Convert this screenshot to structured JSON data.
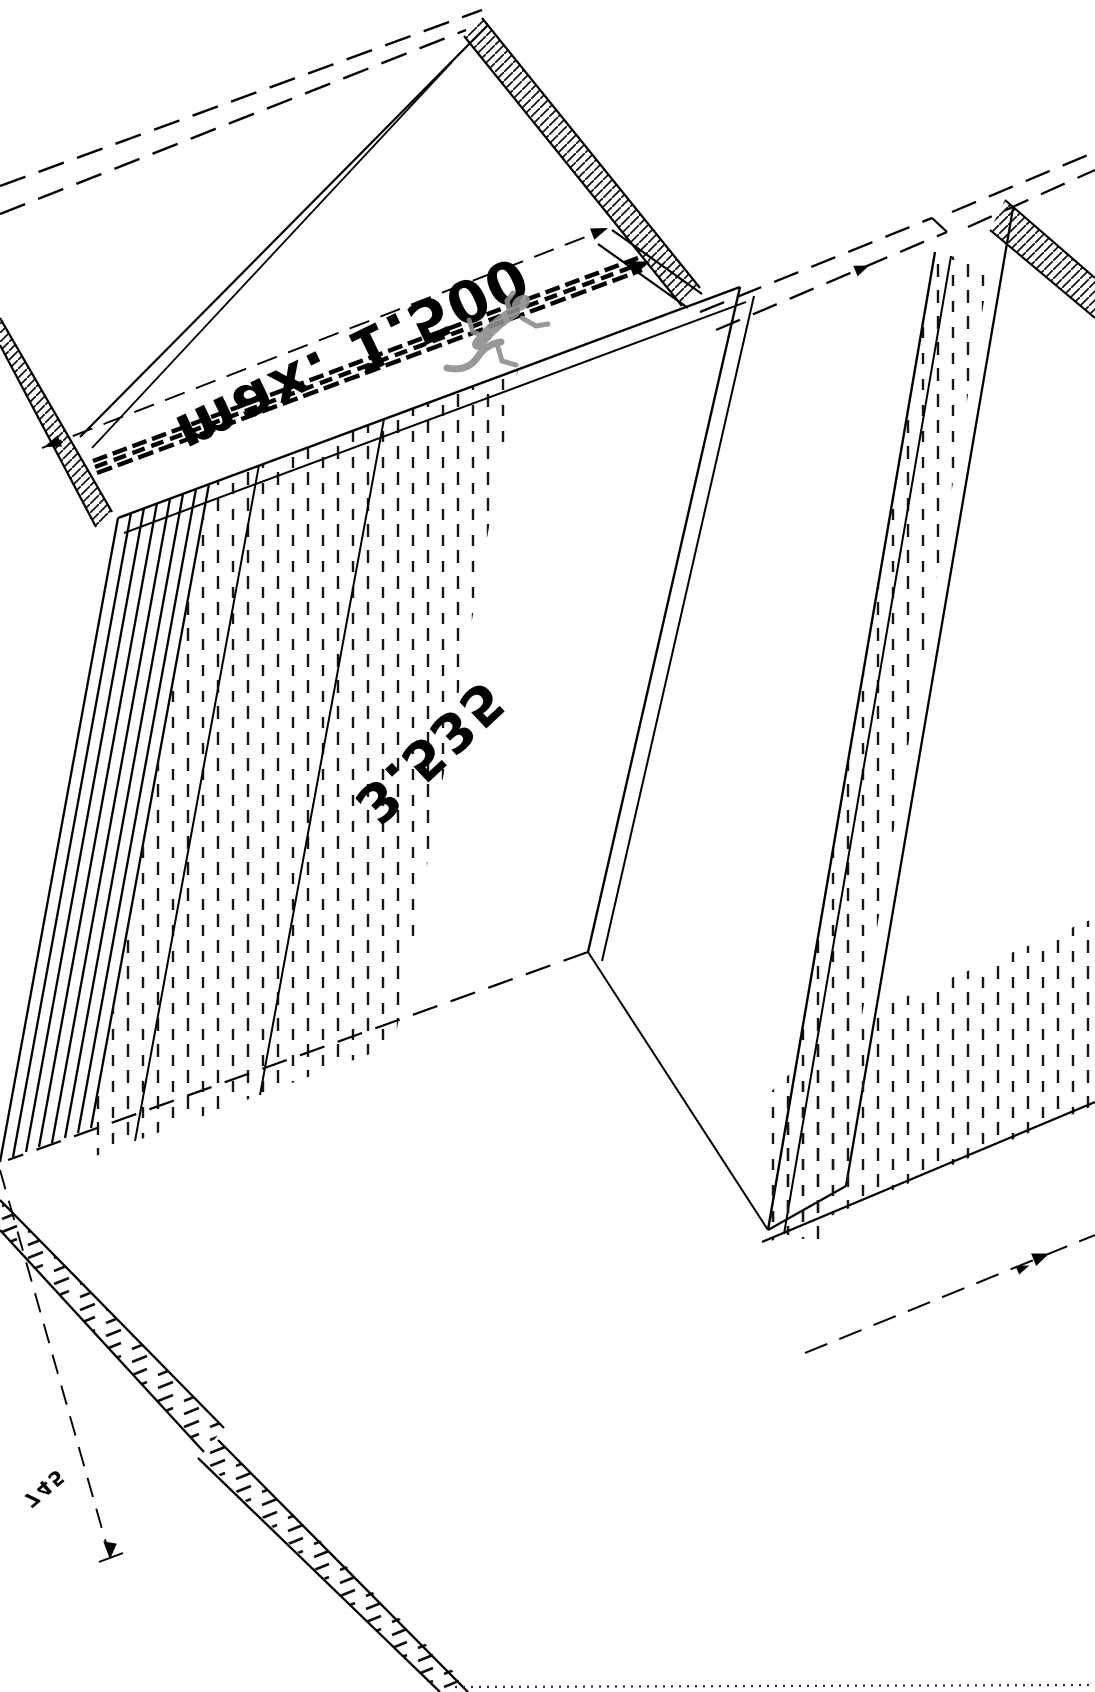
{
  "drawing": {
    "title": "isometric-panel-drawing",
    "background_color": "#ffffff",
    "line_color": "#000000",
    "watermark_color": "#8d8d8d",
    "labels": {
      "top_dimension": "max. 1.500",
      "center_dimension": "3.535",
      "bottom_left_dimension": "745"
    },
    "icons": {
      "watermark": "gecko-figure"
    }
  }
}
